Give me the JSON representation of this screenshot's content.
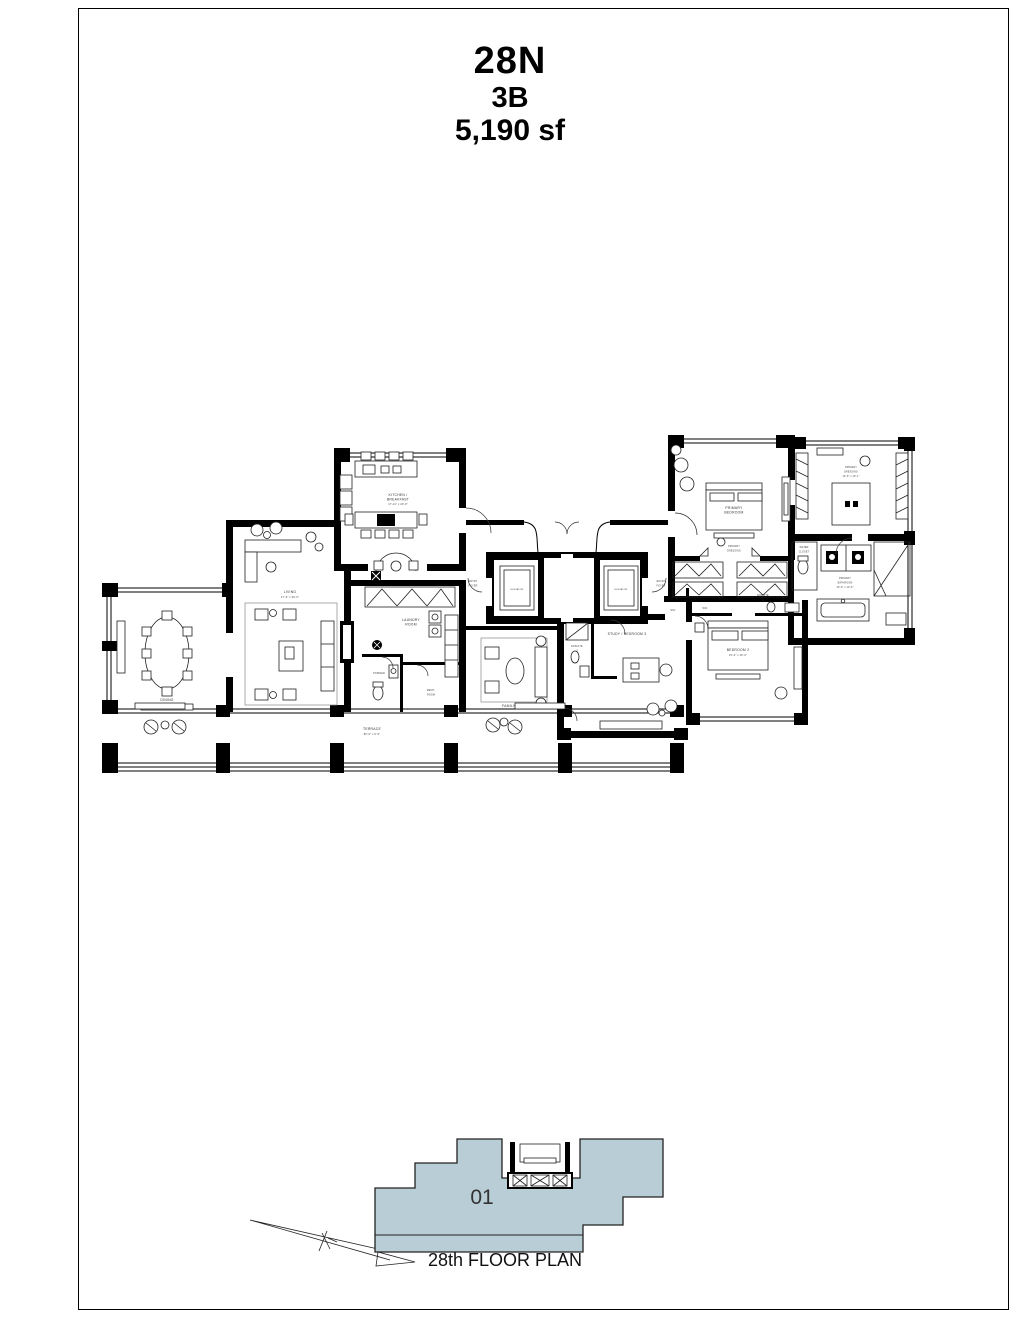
{
  "page": {
    "title_unit": "28N",
    "title_layout": "3B",
    "title_area": "5,190 sf"
  },
  "floor_plan": {
    "rooms": {
      "dining": {
        "label": "DINING"
      },
      "living": {
        "label": "LIVING",
        "dims": "17'-6\" x 30'-6\""
      },
      "kitchen": {
        "line1": "KITCHEN /",
        "line2": "BREAKFAST",
        "dims": "17'-11\" x 20'-0\""
      },
      "laundry": {
        "line1": "LAUNDRY",
        "line2": "ROOM"
      },
      "powder": {
        "label": "POWDER"
      },
      "mech": {
        "line1": "MECH.",
        "line2": "ROOM"
      },
      "family": {
        "label": "FAMILY ROOM"
      },
      "study": {
        "label": "STUDY / BEDROOM 3"
      },
      "ensuite3": {
        "line1": "ENSUITE",
        "line2": "3"
      },
      "bedroom2": {
        "label": "BEDROOM 2",
        "dims": "15'-0\" x 16'-0\""
      },
      "ensuite2": {
        "line1": "ENSUITE",
        "line2": "2"
      },
      "wic": {
        "label": "WIC"
      },
      "primary_bedroom": {
        "line1": "PRIMARY",
        "line2": "BEDROOM"
      },
      "primary_dressing_hall": {
        "line1": "PRIMARY",
        "line2": "DRESSING"
      },
      "primary_dressing": {
        "line1": "PRIMARY",
        "line2": "DRESSING",
        "dims": "16'-8\" x 16'-1\""
      },
      "primary_bath": {
        "line1": "PRIMARY",
        "line2": "BATHROOM",
        "dims": "16'-8\" x 10'-6\""
      },
      "water_closet": {
        "line1": "WATER",
        "line2": "CLOSET"
      },
      "elevator": {
        "label": "ELEVATOR"
      },
      "entry_foyer": {
        "line1": "ENTRY",
        "line2": "FOYER"
      },
      "terrace": {
        "label": "TERRACE",
        "dims": "86'-0\" x 9'-6\""
      }
    }
  },
  "key_plan": {
    "unit_number": "01",
    "caption": "28th FLOOR PLAN",
    "highlight_color": "#b9cdd7"
  }
}
